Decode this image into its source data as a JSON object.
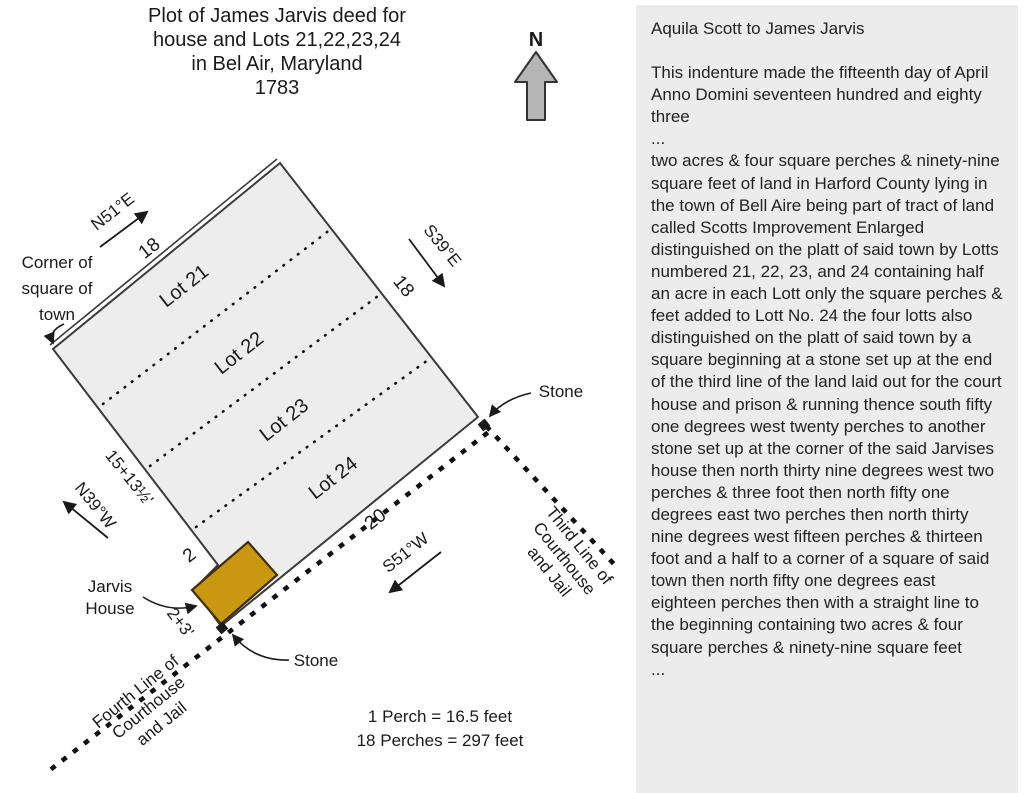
{
  "title": {
    "lines": [
      "Plot of James Jarvis deed for",
      "house and Lots 21,22,23,24",
      "in Bel Air, Maryland",
      "1783"
    ]
  },
  "compass": {
    "north_label": "N"
  },
  "diagram": {
    "corner_label": {
      "lines": [
        "Corner of",
        "square of",
        "town"
      ]
    },
    "bearings": {
      "top": "N51°E",
      "right": "S39°E",
      "left": "N39°W",
      "bottom": "S51°W"
    },
    "edges": {
      "top_length": "18",
      "right_length": "18",
      "left_length": "15+13½'",
      "bottom_length": "20",
      "jog_length": "2",
      "house_side_length": "2+3'"
    },
    "lots": [
      "Lot 21",
      "Lot 22",
      "Lot 23",
      "Lot 24"
    ],
    "jarvis_house": {
      "lines": [
        "Jarvis",
        "House"
      ]
    },
    "stone_right_label": "Stone",
    "stone_bottom_label": "Stone",
    "third_line_label": {
      "lines": [
        "Third Line of",
        "Courthouse",
        "and Jail"
      ]
    },
    "fourth_line_label": {
      "lines": [
        "Fourth Line of",
        "Courthouse",
        "and Jail"
      ]
    },
    "scale": {
      "lines": [
        "1 Perch = 16.5 feet",
        "18 Perches = 297 feet"
      ]
    }
  },
  "deed_panel": {
    "heading": "Aquila Scott to James Jarvis",
    "para1": "This indenture made the fifteenth day of April Anno Domini seventeen hundred and eighty three",
    "ellipsis1": "...",
    "para2": "two acres & four square perches & ninety-nine square feet of land in Harford County lying in the town of Bell Aire being part of tract of land called Scotts Improvement Enlarged distinguished on the platt of said town by Lotts numbered 21, 22, 23, and 24 containing half an acre in each Lott only the square perches & feet added to Lott No. 24 the four lotts also distinguished on the platt of said town by a square beginning at a stone set up at the end of the third line of the land laid out for the court house and prison & running thence south fifty one degrees west twenty perches to another stone set up at the corner of the said Jarvises house then north thirty nine degrees west two perches & three foot then north fifty one degrees east two perches then north thirty nine degrees west fifteen perches & thirteen foot and a half to a corner of a square of said town then north fifty one degrees east eighteen perches then with a straight line to the beginning containing two acres & four square perches & ninety-nine square feet",
    "ellipsis2": "..."
  },
  "colors": {
    "plot_fill": "#ededed",
    "plot_stroke": "#3a3a3a",
    "house_fill": "#c9980f",
    "house_stroke": "#3f3000",
    "compass_fill": "#b5b5b5",
    "panel_bg": "#ececec",
    "dot_color": "#111111"
  }
}
